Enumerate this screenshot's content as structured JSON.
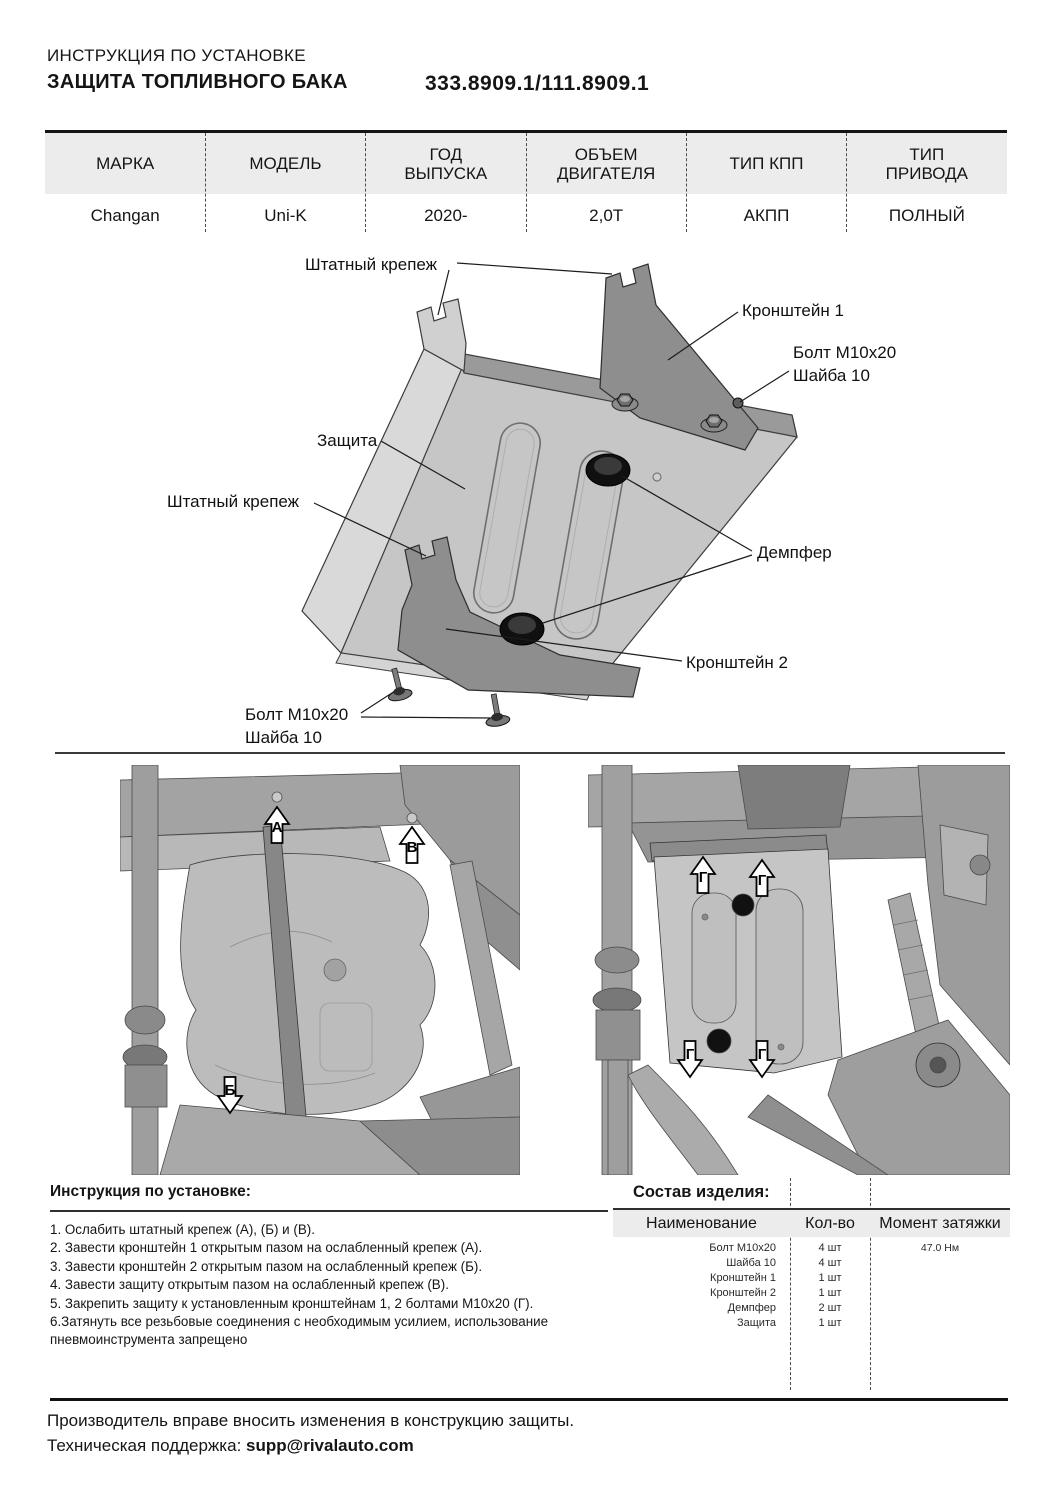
{
  "header": {
    "doc_type": "ИНСТРУКЦИЯ ПО УСТАНОВКЕ",
    "product": "ЗАЩИТА ТОПЛИВНОГО БАКА",
    "part_number": "333.8909.1/111.8909.1"
  },
  "spec_table": {
    "headers": [
      "МАРКА",
      "МОДЕЛЬ",
      "ГОД ВЫПУСКА",
      "ОБЪЕМ ДВИГАТЕЛЯ",
      "ТИП КПП",
      "ТИП ПРИВОДА"
    ],
    "values": [
      "Changan",
      "Uni-K",
      "2020-",
      "2,0Т",
      "АКПП",
      "ПОЛНЫЙ"
    ]
  },
  "diagram": {
    "labels": {
      "factory_mount_top": "Штатный крепеж",
      "bracket1": "Кронштейн 1",
      "bolt_top_line1": "Болт М10х20",
      "bolt_top_line2": "Шайба 10",
      "shield": "Защита",
      "factory_mount_left": "Штатный крепеж",
      "damper": "Демпфер",
      "bracket2": "Кронштейн 2",
      "bolt_bottom_line1": "Болт М10х20",
      "bolt_bottom_line2": "Шайба 10"
    }
  },
  "photos": {
    "left_markers": {
      "a": "А",
      "b": "Б",
      "v": "В"
    },
    "right_marker": "Г"
  },
  "instructions": {
    "title": "Инструкция по установке:",
    "steps": [
      "1. Ослабить штатный крепеж (А), (Б) и (В).",
      "2. Завести кронштейн 1 открытым пазом на ослабленный крепеж (А).",
      "3. Завести кронштейн 2 открытым пазом на ослабленный крепеж (Б).",
      "4. Завести защиту открытым пазом на ослабленный крепеж (В).",
      "5. Закрепить защиту к установленным кронштейнам 1, 2 болтами М10х20 (Г).",
      "6.Затянуть все резьбовые соединения с необходимым усилием, использование пневмоинструмента запрещено"
    ]
  },
  "parts_table": {
    "title": "Состав изделия:",
    "headers": [
      "Наименование",
      "Кол-во",
      "Момент затяжки"
    ],
    "rows": [
      {
        "name": "Болт М10х20",
        "qty": "4 шт",
        "torque": "47.0 Нм"
      },
      {
        "name": "Шайба 10",
        "qty": "4 шт",
        "torque": ""
      },
      {
        "name": "Кронштейн 1",
        "qty": "1 шт",
        "torque": ""
      },
      {
        "name": "Кронштейн 2",
        "qty": "1 шт",
        "torque": ""
      },
      {
        "name": "Демпфер",
        "qty": "2 шт",
        "torque": ""
      },
      {
        "name": "Защита",
        "qty": "1 шт",
        "torque": ""
      }
    ]
  },
  "footer": {
    "note": "Производитель вправе вносить изменения в конструкцию защиты.",
    "support_label": "Техническая поддержка: ",
    "support_email": "supp@rivalauto.com"
  }
}
